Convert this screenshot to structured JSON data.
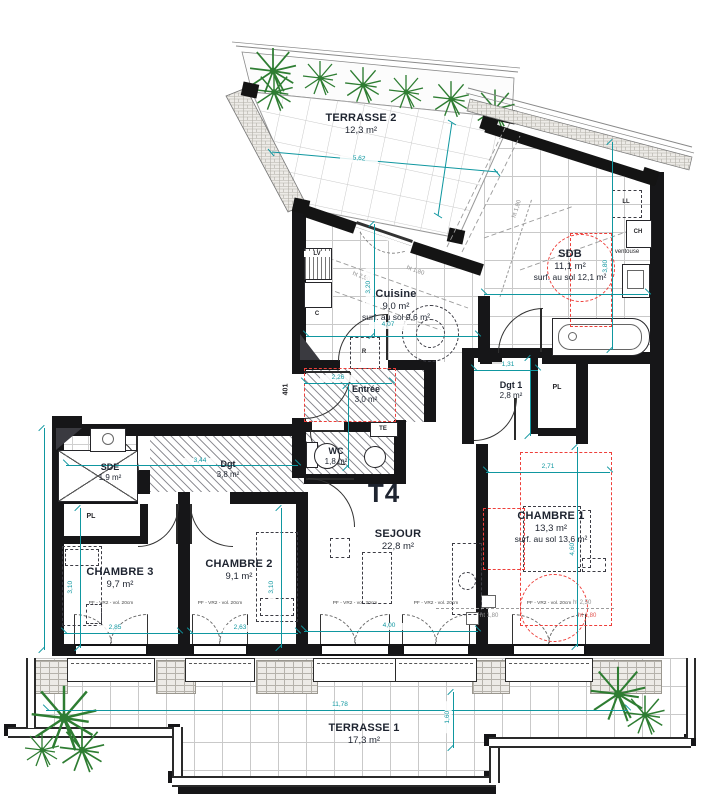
{
  "unit": {
    "type_label": "T4"
  },
  "rooms": {
    "terrasse2": {
      "name": "TERRASSE 2",
      "area": "12,3 m²"
    },
    "sdb": {
      "name": "SDB",
      "area": "11,1 m²",
      "floor": "surf. au sol 12,1 m²"
    },
    "cuisine": {
      "name": "Cuisine",
      "area": "9,0 m²",
      "floor": "surf. au sol 9,6 m²"
    },
    "entree": {
      "name": "Entrée",
      "area": "3,0 m²"
    },
    "dgt1": {
      "name": "Dgt 1",
      "area": "2,8 m²"
    },
    "wc": {
      "name": "WC",
      "area": "1,8 m²"
    },
    "sde": {
      "name": "SDE",
      "area": "1,9 m²"
    },
    "dgt": {
      "name": "Dgt",
      "area": "3,8 m²"
    },
    "sejour": {
      "name": "SEJOUR",
      "area": "22,8 m²"
    },
    "chambre1": {
      "name": "CHAMBRE 1",
      "area": "13,3 m²",
      "floor": "surf. au sol 13,6 m²"
    },
    "chambre2": {
      "name": "CHAMBRE 2",
      "area": "9,1 m²"
    },
    "chambre3": {
      "name": "CHAMBRE 3",
      "area": "9,7 m²"
    },
    "terrasse1": {
      "name": "TERRASSE 1",
      "area": "17,3 m²"
    }
  },
  "dimensions": {
    "terrasse2_length": "5,62",
    "cuisine_width": "4,07",
    "cuisine_depth": "3,20",
    "entree_width": "2,26",
    "dgt_length": "3,44",
    "dgt1_width": "1,31",
    "sdb_depth": "3,80",
    "chambre1_width": "2,71",
    "chambre1_depth": "4,60",
    "chambre2_width": "2,63",
    "chambre2_depth": "3,10",
    "chambre3_width": "2,85",
    "chambre3_depth": "3,10",
    "sejour_width": "4,00",
    "terrasse1_length": "11,78",
    "terrasse1_depth": "1,60"
  },
  "annotations": {
    "apartment_door_number": "401",
    "closet": "PL",
    "dishwasher": "LV",
    "fridge": "R",
    "c_mark": "C",
    "te_mark": "TE",
    "washing_machine": "LL",
    "boiler": "CH",
    "ventouse": "ventouse",
    "height_250": "ht 2,50",
    "height_180": "ht 1,80"
  },
  "windows": {
    "label": "PF - VR2 - vol. 20cm"
  },
  "colors": {
    "wall": "#161618",
    "dimension": "#0f97a0",
    "red_zone": "#ee3f3a",
    "plant": "#2e7d32",
    "tile_grid": "#c9c9c9",
    "height_line": "#9b9b9b"
  }
}
